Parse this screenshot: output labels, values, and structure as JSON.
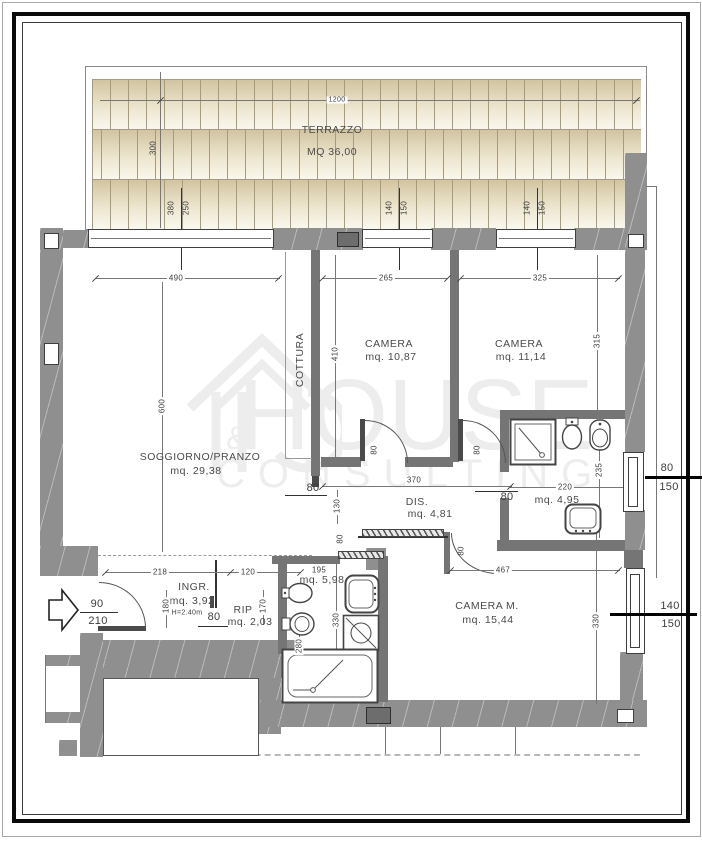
{
  "colors": {
    "wall": "#8f8f8f",
    "tile_dark": "#d2c4a0",
    "tile_light": "#faf8ef",
    "line": "#777777",
    "text": "#3c3c3c",
    "watermark": "#ededed",
    "frame": "#000000"
  },
  "watermark": {
    "word1": "HOUSE",
    "word2": "CONSULTING",
    "amp": "&"
  },
  "labels": {
    "terrace_title": "TERRAZZO",
    "terrace_area": "MQ 36,00",
    "dim_1200": "1200",
    "dim_300": "300",
    "win1_w": "380",
    "win1_h": "250",
    "win2_w": "140",
    "win2_h": "150",
    "win3_w": "140",
    "win3_h": "150",
    "dim_490": "490",
    "dim_265": "265",
    "dim_325": "325",
    "dim_600": "600",
    "cottura": "COTTURA",
    "dim_410": "410",
    "camera1_name": "CAMERA",
    "camera1_area": "mq. 10,87",
    "camera2_name": "CAMERA",
    "camera2_area": "mq. 11,14",
    "dim_315": "315",
    "soggiorno_name": "SOGGIORNO/PRANZO",
    "soggiorno_area": "mq. 29,38",
    "dim_80_kitchen": "80",
    "dim_130": "130",
    "dim_80_c1": "80",
    "dim_80_c2": "80",
    "dim_370": "370",
    "dis_name": "DIS.",
    "dis_area": "mq. 4,81",
    "dim_80_c2b": "80",
    "bath1_area": "mq. 4,95",
    "dim_235": "235",
    "dim_220": "220",
    "win_r1_w": "80",
    "win_r1_h": "150",
    "door_main_w": "90",
    "door_main_h": "210",
    "dim_218": "218",
    "dim_120": "120",
    "ingresso_name": "INGR.",
    "ingresso_area": "mq. 3,92",
    "ingresso_height": "H=2.40m",
    "dim_180": "180",
    "dim_80_ingr": "80",
    "rip_name": "RIP",
    "rip_area": "mq. 2,03",
    "dim_170": "170",
    "dim_195": "195",
    "bath2_area": "mq. 5,98",
    "dim_280": "280",
    "dim_330_bath": "330",
    "dim_80_bath": "80",
    "dim_80_cm": "80",
    "dim_467": "467",
    "cameram_name": "CAMERA M.",
    "cameram_area": "mq. 15,44",
    "dim_330_cm": "330",
    "win_r2_w": "140",
    "win_r2_h": "150"
  }
}
